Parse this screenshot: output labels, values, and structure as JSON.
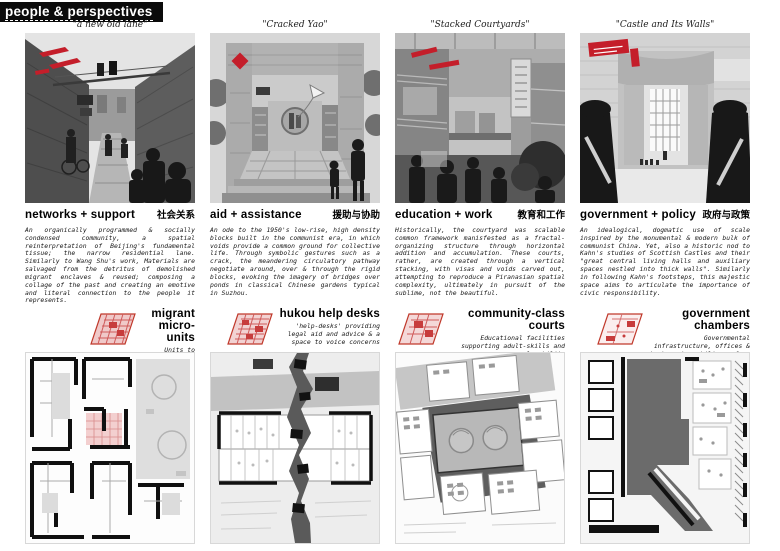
{
  "header": {
    "title": "people & perspectives"
  },
  "accent_red": "#c41e2a",
  "top_sections": [
    {
      "caption": "\"a new old lane\"",
      "title": "networks + support",
      "title_zh": "社会关系",
      "body": "An organically programmed & socially condensed community, a spatial reinterpretation of Beijing's fundamental tissue; the narrow residential lane. Similarly to Wang Shu's work, Materials are salvaged from the detritus of demolished migrant enclaves & reused; composing a collage of the past and creating an emotive and literal connection to the people it represents."
    },
    {
      "caption": "\"Cracked Yao\"",
      "title": "aid + assistance",
      "title_zh": "援助与协助",
      "body": "An ode to the 1950's low-rise, high density blocks built in the communist era, in which voids provide a common ground for collective life. Through symbolic gestures such as a crack, the meandering circulatory pathway negotiate around, over & through the rigid blocks, evoking the imagery of bridges over ponds in classical Chinese gardens typical in Suzhou."
    },
    {
      "caption": "\"Stacked Courtyards\"",
      "title": "education + work",
      "title_zh": "教育和工作",
      "body": "Historically, the courtyard was scalable common framework manisfested as a fractal-organizing structure through horizontal addition and accumulation. These courts, rather, are created through a vertical stacking, with visas and voids carved out, attempting to reproduce a Piranasian spatial complexity, ultimately in pursuit of the sublime, not the beautiful."
    },
    {
      "caption": "\"Castle and Its Walls\"",
      "title": "government + policy",
      "title_zh": "政府与政策",
      "body": "An idealogical, dogmatic use of scale inspired by the monumental & modern bulk of communist China. Yet, also a historic nod to Kahn's studies of Scottish Castles and their \"great central living halls and auxiliary spaces nestled into thick walls\". Similarly in following Kahn's footsteps, this majestic space aims to articulate the importance of civic responsibility."
    }
  ],
  "bottom_sections": [
    {
      "title": "migrant micro-units",
      "desc": "Units to appropriate, bolstering internal socio-economic networks"
    },
    {
      "title": "hukou help desks",
      "desc": "'help-desks' providing legal aid and advice & a space to voice concerns"
    },
    {
      "title": "community-class courts",
      "desc": "Educational facilities supporting adult-skills and employability"
    },
    {
      "title": "government chambers",
      "desc": "Governmental infrastructure, offices & chambers to mobilise reform"
    }
  ]
}
